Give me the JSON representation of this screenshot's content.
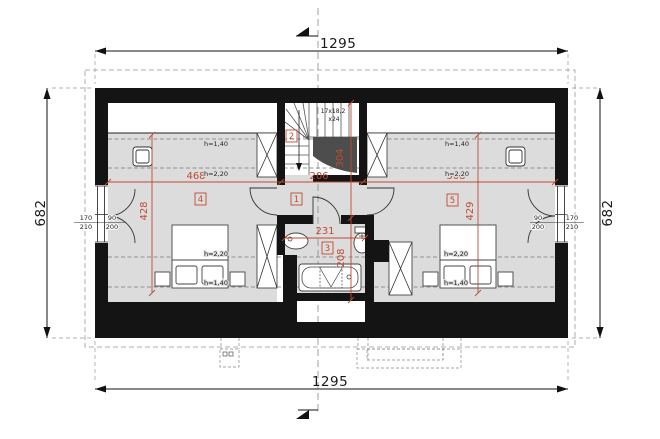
{
  "colors": {
    "red": "#bf4a32",
    "floor": "#dcdcdc",
    "wall": "#141414"
  },
  "outer_dims": {
    "top": "1295",
    "bottom": "1295",
    "left": "682",
    "right": "682"
  },
  "room_dims": {
    "bed_left_w": "468",
    "bed_left_d": "428",
    "hall_w": "206",
    "stair_d": "304",
    "bath_w": "231",
    "bath_d": "208",
    "bed_right_w": "508",
    "bed_right_d": "429"
  },
  "room_numbers": {
    "hall": "1",
    "staircase": "2",
    "bathroom": "3",
    "bed_left": "4",
    "bed_right": "5"
  },
  "height_labels": {
    "low": "h=1,40",
    "high": "h=2,20"
  },
  "stair_note": {
    "line1": "17x18,2",
    "line2": "x24"
  },
  "opening_sizes": {
    "window_w": "170",
    "window_h": "210",
    "door_w": "90",
    "door_h": "200"
  }
}
